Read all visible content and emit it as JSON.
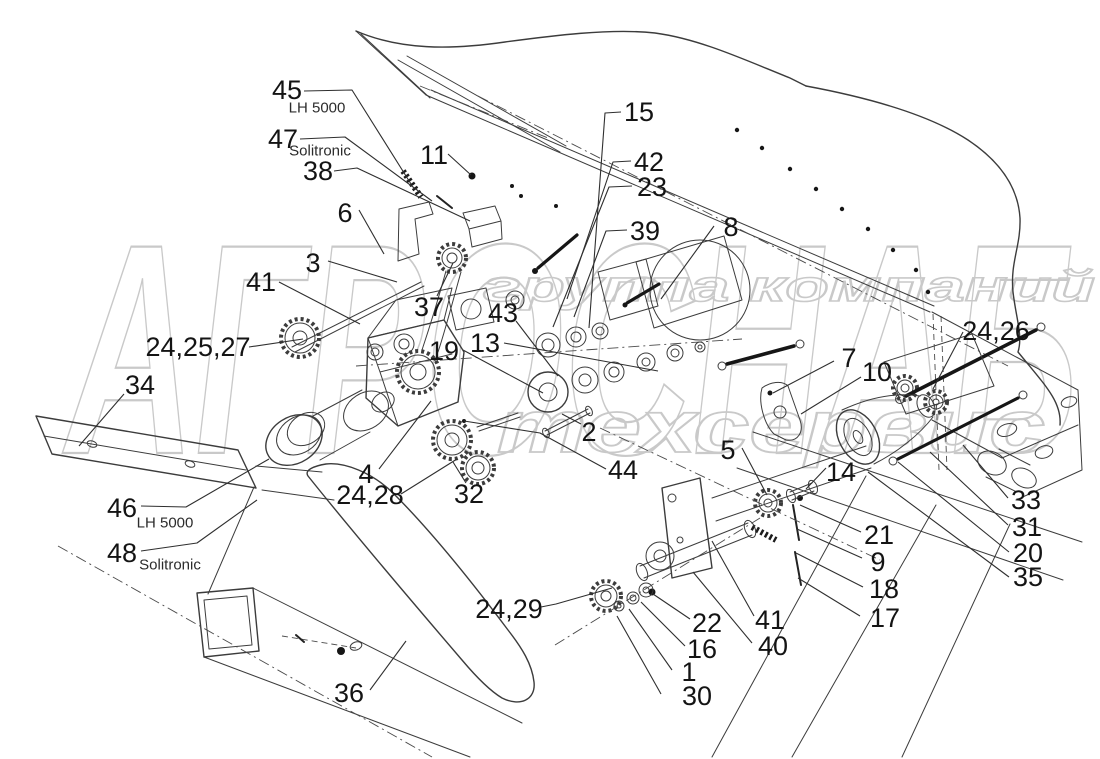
{
  "figure": {
    "diagram_type": "exploded-parts-diagram",
    "background": "#ffffff",
    "line_color": "#3c3c3c",
    "watermark_color": "#c9c9c9"
  },
  "watermark": {
    "line1": "группа компаний",
    "line2": "АГРОСНАБ",
    "line3": "техсервис"
  },
  "callouts": [
    {
      "t": "45",
      "x": 287,
      "y": 90,
      "sub": {
        "t": "LH 5000",
        "x": 317,
        "y": 108
      },
      "l": [
        [
          304,
          91
        ],
        [
          352,
          90
        ],
        [
          411,
          184
        ]
      ]
    },
    {
      "t": "47",
      "x": 283,
      "y": 139,
      "sub": {
        "t": "Solitronic",
        "x": 320,
        "y": 151
      },
      "l": [
        [
          300,
          139
        ],
        [
          345,
          137
        ],
        [
          432,
          201
        ]
      ]
    },
    {
      "t": "38",
      "x": 318,
      "y": 171,
      "l": [
        [
          334,
          171
        ],
        [
          357,
          168
        ],
        [
          470,
          221
        ]
      ]
    },
    {
      "t": "11",
      "x": 434,
      "y": 155,
      "l": [
        [
          448,
          154
        ],
        [
          471,
          175
        ]
      ]
    },
    {
      "t": "6",
      "x": 345,
      "y": 213,
      "l": [
        [
          359,
          210
        ],
        [
          384,
          254
        ]
      ]
    },
    {
      "t": "3",
      "x": 313,
      "y": 263,
      "l": [
        [
          328,
          261
        ],
        [
          397,
          282
        ]
      ]
    },
    {
      "t": "41",
      "x": 261,
      "y": 282,
      "l": [
        [
          279,
          282
        ],
        [
          360,
          324
        ]
      ]
    },
    {
      "t": "24,25,27",
      "x": 198,
      "y": 347,
      "l": [
        [
          249,
          347
        ],
        [
          303,
          339
        ]
      ]
    },
    {
      "t": "34",
      "x": 140,
      "y": 385,
      "l": [
        [
          124,
          394
        ],
        [
          79,
          446
        ]
      ]
    },
    {
      "t": "37",
      "x": 429,
      "y": 307,
      "l": [
        [
          437,
          296
        ],
        [
          453,
          263
        ]
      ]
    },
    {
      "t": "43",
      "x": 503,
      "y": 313,
      "l": [
        [
          516,
          321
        ],
        [
          558,
          376
        ]
      ]
    },
    {
      "t": "13",
      "x": 485,
      "y": 343,
      "l": [
        [
          504,
          343
        ],
        [
          658,
          371
        ]
      ]
    },
    {
      "t": "19",
      "x": 444,
      "y": 351,
      "l": [
        [
          463,
          350
        ],
        [
          543,
          393
        ]
      ]
    },
    {
      "t": "15",
      "x": 639,
      "y": 112,
      "l": [
        [
          621,
          112
        ],
        [
          605,
          113
        ],
        [
          589,
          328
        ]
      ]
    },
    {
      "t": "42",
      "x": 649,
      "y": 162,
      "l": [
        [
          631,
          161
        ],
        [
          613,
          162
        ],
        [
          567,
          299
        ]
      ]
    },
    {
      "t": "23",
      "x": 652,
      "y": 187,
      "l": [
        [
          632,
          186
        ],
        [
          609,
          187
        ],
        [
          553,
          327
        ]
      ]
    },
    {
      "t": "39",
      "x": 645,
      "y": 231,
      "l": [
        [
          627,
          230
        ],
        [
          606,
          231
        ],
        [
          574,
          317
        ]
      ]
    },
    {
      "t": "8",
      "x": 731,
      "y": 227,
      "l": [
        [
          714,
          226
        ],
        [
          661,
          299
        ]
      ]
    },
    {
      "t": "7",
      "x": 849,
      "y": 358,
      "l": [
        [
          834,
          361
        ],
        [
          773,
          393
        ]
      ]
    },
    {
      "t": "10",
      "x": 877,
      "y": 372,
      "l": [
        [
          861,
          377
        ],
        [
          801,
          414
        ]
      ]
    },
    {
      "t": "24,26",
      "x": 996,
      "y": 331,
      "l": [
        [
          963,
          332
        ],
        [
          933,
          389
        ]
      ]
    },
    {
      "t": "2",
      "x": 589,
      "y": 432,
      "l": [
        [
          581,
          424
        ],
        [
          562,
          414
        ]
      ]
    },
    {
      "t": "44",
      "x": 623,
      "y": 470,
      "l": [
        [
          606,
          469
        ],
        [
          540,
          433
        ],
        [
          464,
          421
        ]
      ]
    },
    {
      "t": "4",
      "x": 366,
      "y": 474,
      "l": [
        [
          379,
          469
        ],
        [
          431,
          401
        ]
      ]
    },
    {
      "t": "24,28",
      "x": 370,
      "y": 495,
      "l": [
        [
          401,
          494
        ],
        [
          457,
          459
        ]
      ]
    },
    {
      "t": "32",
      "x": 469,
      "y": 494,
      "l": [
        [
          466,
          483
        ],
        [
          453,
          462
        ]
      ]
    },
    {
      "t": "5",
      "x": 728,
      "y": 450,
      "l": [
        [
          742,
          448
        ],
        [
          767,
          495
        ]
      ]
    },
    {
      "t": "14",
      "x": 841,
      "y": 472,
      "l": [
        [
          826,
          468
        ],
        [
          806,
          489
        ]
      ]
    },
    {
      "t": "21",
      "x": 879,
      "y": 535,
      "l": [
        [
          861,
          532
        ],
        [
          800,
          505
        ]
      ]
    },
    {
      "t": "9",
      "x": 878,
      "y": 562,
      "l": [
        [
          862,
          558
        ],
        [
          797,
          529
        ]
      ]
    },
    {
      "t": "18",
      "x": 884,
      "y": 589,
      "l": [
        [
          863,
          587
        ],
        [
          796,
          553
        ]
      ]
    },
    {
      "t": "17",
      "x": 885,
      "y": 618,
      "l": [
        [
          860,
          616
        ],
        [
          798,
          578
        ]
      ]
    },
    {
      "t": "33",
      "x": 1026,
      "y": 500,
      "l": [
        [
          1008,
          498
        ],
        [
          963,
          445
        ]
      ]
    },
    {
      "t": "31",
      "x": 1027,
      "y": 527,
      "l": [
        [
          1008,
          525
        ],
        [
          930,
          452
        ]
      ]
    },
    {
      "t": "20",
      "x": 1028,
      "y": 553,
      "l": [
        [
          1009,
          552
        ],
        [
          898,
          462
        ]
      ]
    },
    {
      "t": "35",
      "x": 1028,
      "y": 577,
      "l": [
        [
          1009,
          577
        ],
        [
          868,
          472
        ]
      ]
    },
    {
      "t": "46",
      "x": 122,
      "y": 508,
      "sub": {
        "t": "LH 5000",
        "x": 165,
        "y": 523
      },
      "l": [
        [
          141,
          506
        ],
        [
          186,
          507
        ],
        [
          269,
          459
        ]
      ]
    },
    {
      "t": "48",
      "x": 122,
      "y": 553,
      "sub": {
        "t": "Solitronic",
        "x": 170,
        "y": 565
      },
      "l": [
        [
          141,
          551
        ],
        [
          197,
          543
        ],
        [
          257,
          500
        ]
      ]
    },
    {
      "t": "24,29",
      "x": 509,
      "y": 609,
      "l": [
        [
          541,
          607
        ],
        [
          556,
          604
        ],
        [
          612,
          588
        ]
      ]
    },
    {
      "t": "22",
      "x": 707,
      "y": 623,
      "l": [
        [
          690,
          619
        ],
        [
          653,
          594
        ]
      ]
    },
    {
      "t": "16",
      "x": 702,
      "y": 649,
      "l": [
        [
          685,
          646
        ],
        [
          641,
          602
        ]
      ]
    },
    {
      "t": "1",
      "x": 689,
      "y": 672,
      "l": [
        [
          672,
          670
        ],
        [
          629,
          609
        ]
      ]
    },
    {
      "t": "30",
      "x": 697,
      "y": 696,
      "l": [
        [
          661,
          694
        ],
        [
          617,
          616
        ]
      ]
    },
    {
      "t": "41",
      "x": 770,
      "y": 620,
      "l": [
        [
          754,
          616
        ],
        [
          712,
          541
        ]
      ]
    },
    {
      "t": "40",
      "x": 773,
      "y": 646,
      "l": [
        [
          752,
          643
        ],
        [
          693,
          572
        ]
      ]
    },
    {
      "t": "36",
      "x": 349,
      "y": 693,
      "l": [
        [
          370,
          690
        ],
        [
          406,
          641
        ]
      ]
    }
  ]
}
